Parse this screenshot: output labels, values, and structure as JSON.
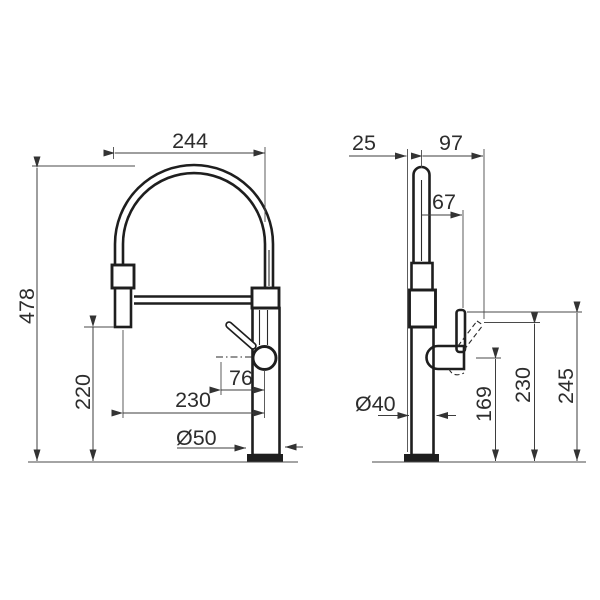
{
  "colors": {
    "background": "#ffffff",
    "object_line": "#1e1e1e",
    "dimension_line": "#3d3d3d"
  },
  "front_view": {
    "dims": {
      "spout_width": "244",
      "overall_height": "478",
      "spray_head_clearance": "220",
      "spray_to_handle_offset": "230",
      "lever_offset": "76",
      "base_diameter": "Ø50"
    }
  },
  "side_view": {
    "dims": {
      "spout_setback": "25",
      "handle_tip_reach": "97",
      "lever_reach": "67",
      "body_diameter": "Ø40",
      "spray_outlet_height": "169",
      "handle_tip_height": "230",
      "handle_top_height": "245"
    }
  }
}
